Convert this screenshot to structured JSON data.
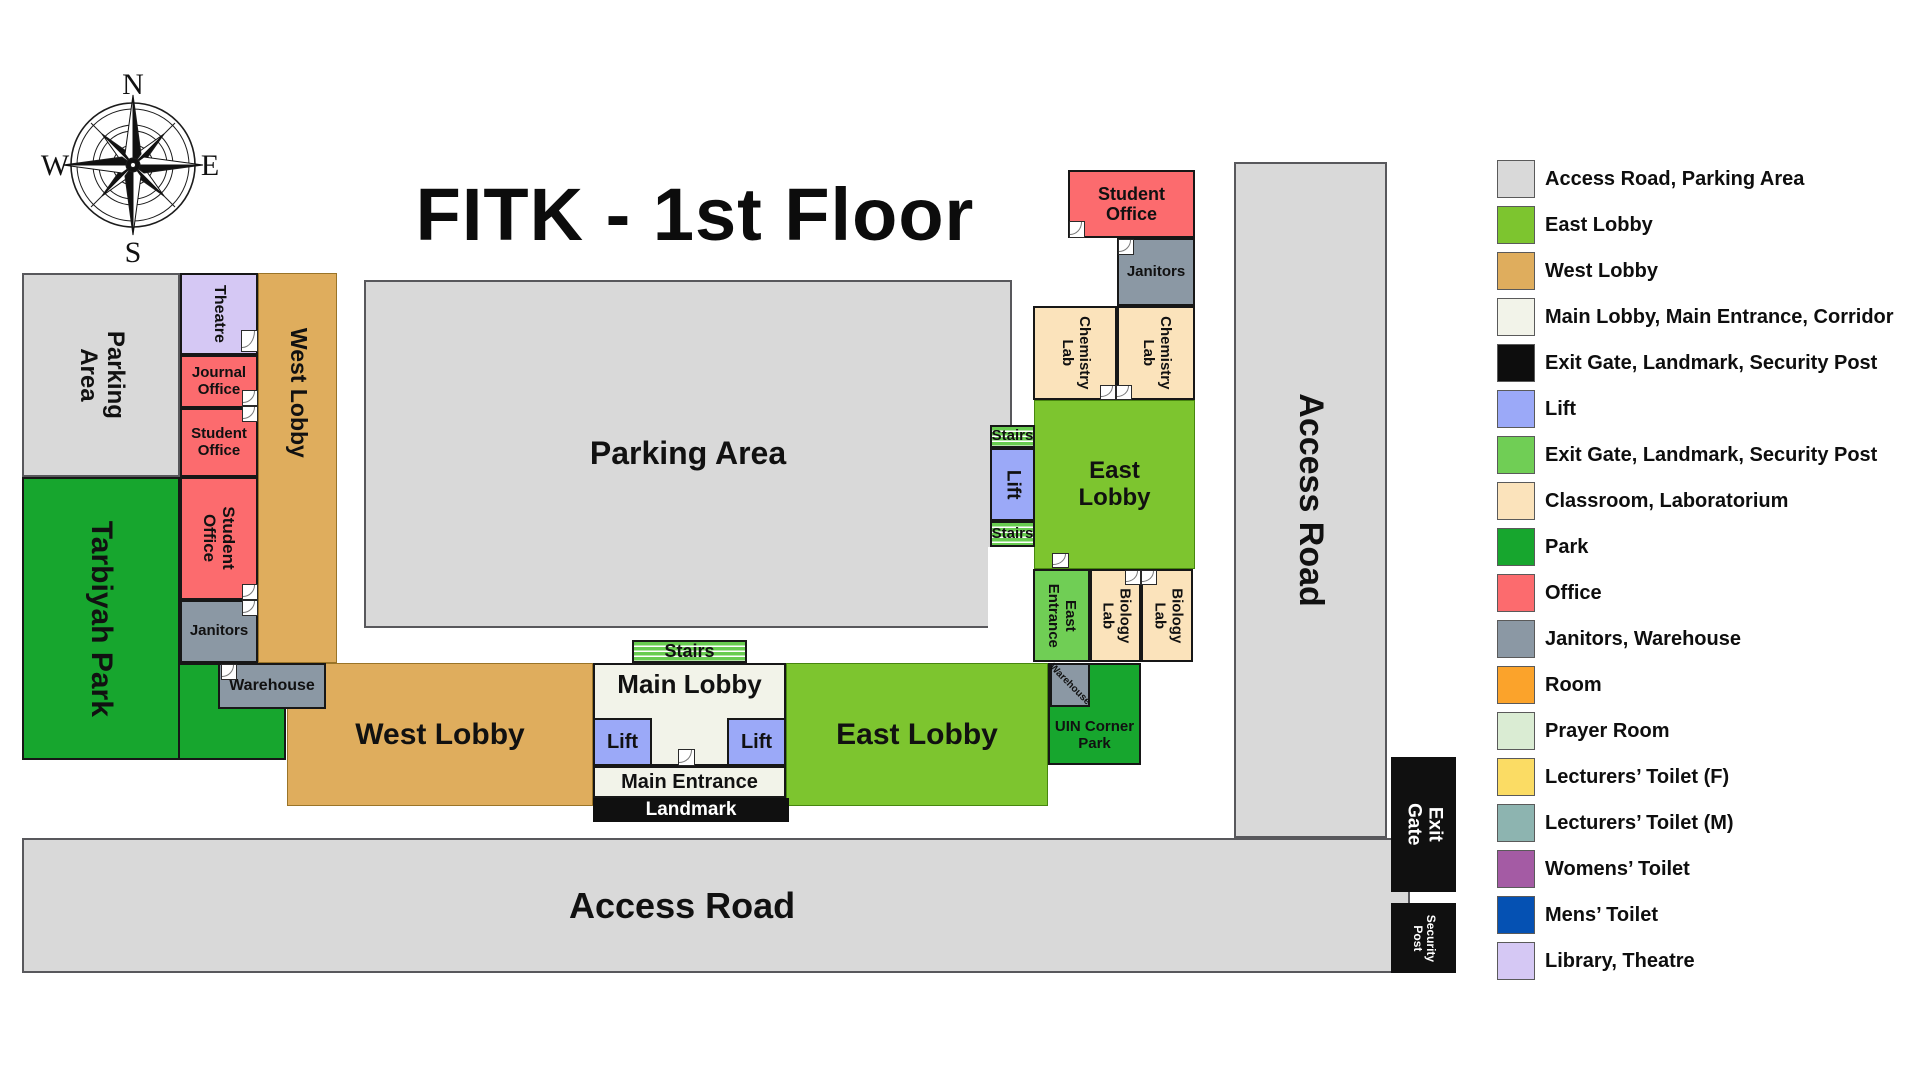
{
  "title": "FITK - 1st Floor",
  "compass": {
    "north": "N",
    "east": "E",
    "south": "S",
    "west": "W"
  },
  "map": {
    "parking_area_left": "Parking Area",
    "tarbiyah_park": "Tarbiyah Park",
    "theatre": "Theatre",
    "journal_office": "Journal Office",
    "student_office_upper": "Student Office",
    "student_office_lower": "Student Office",
    "janitors_west": "Janitors",
    "warehouse_west": "Warehouse",
    "west_lobby_wing": "West Lobby",
    "parking_area_main": "Parking Area",
    "west_lobby": "West Lobby",
    "stairs_main": "Stairs",
    "main_lobby": "Main Lobby",
    "lift_left": "Lift",
    "lift_right": "Lift",
    "main_entrance": "Main Entrance",
    "landmark": "Landmark",
    "east_lobby": "East Lobby",
    "uin_corner_park": "UIN Corner Park",
    "warehouse_east": "Warehouse",
    "east_entrance": "East Entrance",
    "biology_lab_west": "Biology Lab",
    "biology_lab_east": "Biology Lab",
    "east_lobby_block": "East Lobby",
    "stairs_upper": "Stairs",
    "lift_east": "Lift",
    "stairs_lower": "Stairs",
    "chemistry_lab_west": "Chemistry Lab",
    "chemistry_lab_east": "Chemistry Lab",
    "janitors_east": "Janitors",
    "student_office_east": "Student Office",
    "access_road_east": "Access Road",
    "access_road_south": "Access Road",
    "exit_gate": "Exit Gate",
    "security_post": "Security Post"
  },
  "legend": {
    "items": [
      {
        "label": "Access Road, Parking Area",
        "color": "#D9D9D9"
      },
      {
        "label": "East Lobby",
        "color": "#7DC52F"
      },
      {
        "label": "West Lobby",
        "color": "#DFAD5D"
      },
      {
        "label": "Main Lobby, Main Entrance, Corridor",
        "color": "#F2F3E9"
      },
      {
        "label": "Exit Gate, Landmark, Security Post",
        "color": "#0D0D0D"
      },
      {
        "label": "Lift",
        "color": "#9BA9F8"
      },
      {
        "label": "Exit Gate, Landmark, Security Post",
        "color": "#70CE55"
      },
      {
        "label": "Classroom, Laboratorium",
        "color": "#FBE3BB"
      },
      {
        "label": "Park",
        "color": "#17A62E"
      },
      {
        "label": "Office",
        "color": "#FC6B6E"
      },
      {
        "label": "Janitors, Warehouse",
        "color": "#8B98A4"
      },
      {
        "label": "Room",
        "color": "#FBA32B"
      },
      {
        "label": "Prayer Room",
        "color": "#DAECD3"
      },
      {
        "label": "Lecturers’ Toilet (F)",
        "color": "#FBDC64"
      },
      {
        "label": "Lecturers’ Toilet (M)",
        "color": "#8DB4B0"
      },
      {
        "label": "Womens’ Toilet",
        "color": "#A45BA4"
      },
      {
        "label": "Mens’ Toilet",
        "color": "#0551B3"
      },
      {
        "label": "Library, Theatre",
        "color": "#D5C8F4"
      }
    ]
  }
}
